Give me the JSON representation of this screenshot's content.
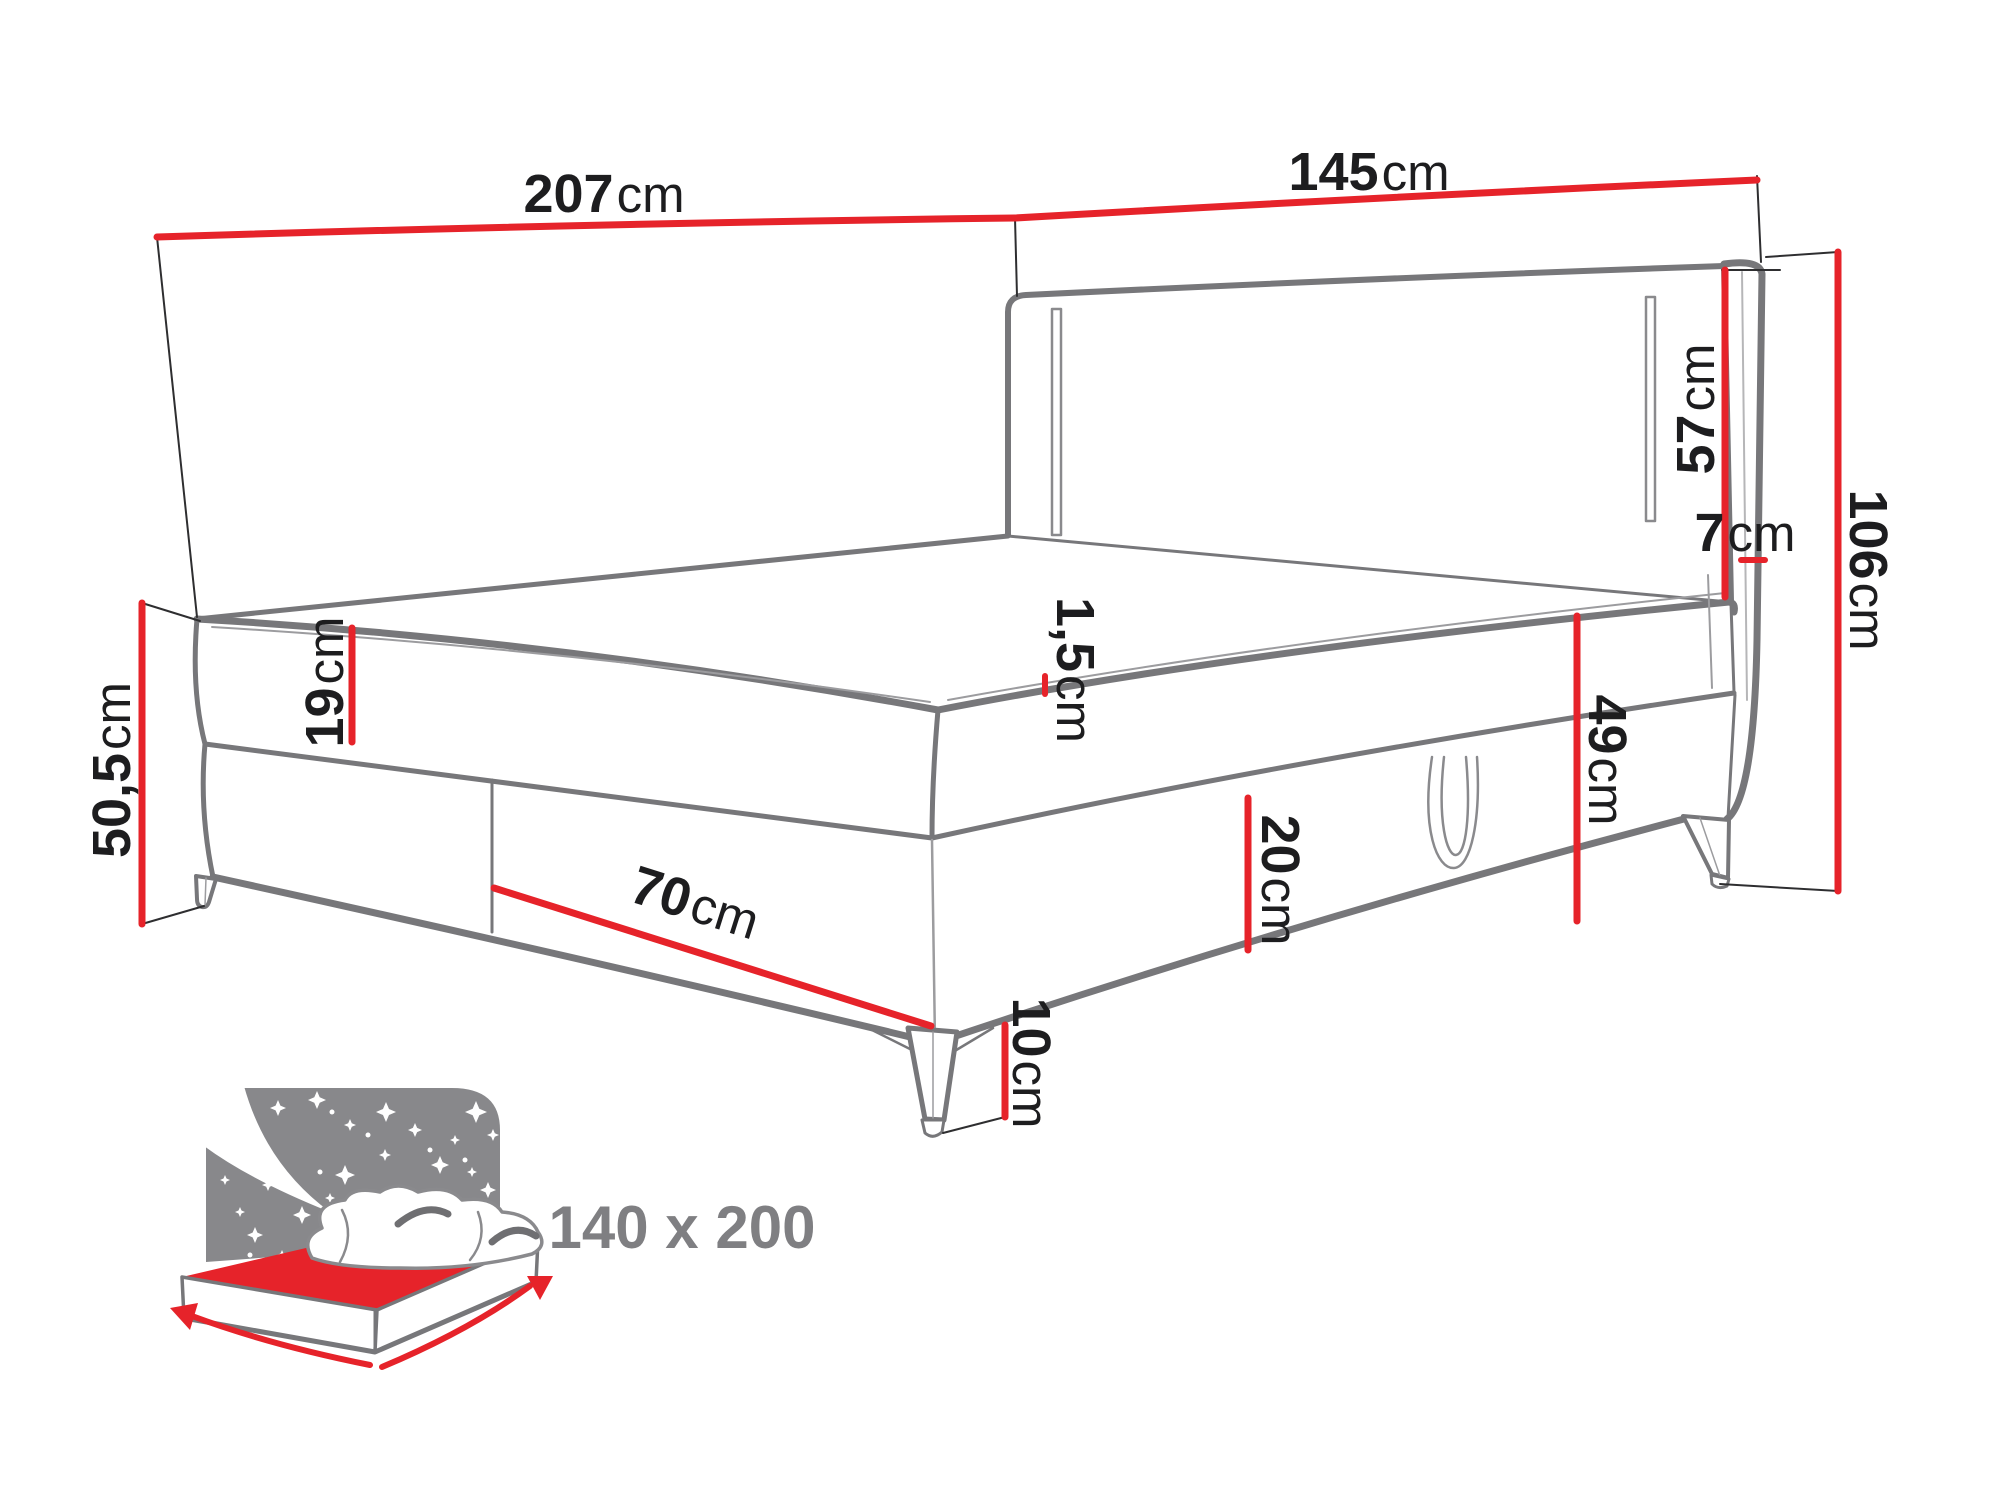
{
  "diagram": {
    "type": "furniture-dimension-diagram",
    "product": "boxspring bed with LED headboard",
    "unit": "cm",
    "dims": {
      "length": {
        "value": "207",
        "unit": "cm"
      },
      "width": {
        "value": "145",
        "unit": "cm"
      },
      "headboard_height": {
        "value": "57",
        "unit": "cm"
      },
      "headboard_depth": {
        "value": "7",
        "unit": "cm"
      },
      "total_height": {
        "value": "106",
        "unit": "cm"
      },
      "topper": {
        "value": "1,5",
        "unit": "cm"
      },
      "mattress": {
        "value": "19",
        "unit": "cm"
      },
      "seat_height": {
        "value": "50,5",
        "unit": "cm"
      },
      "storage": {
        "value": "70",
        "unit": "cm"
      },
      "base": {
        "value": "20",
        "unit": "cm"
      },
      "side_height": {
        "value": "49",
        "unit": "cm"
      },
      "leg": {
        "value": "10",
        "unit": "cm"
      }
    },
    "badge": {
      "size": "140 x 200"
    },
    "icons": [
      "bed-size-icon",
      "starry-headboard-icon",
      "moon-icon",
      "measure-arrow-icon"
    ],
    "colors": {
      "dimension_red": "#e6232a",
      "outline_grey": "#77777a",
      "icon_grey": "#88888b",
      "label_black": "#1d1d1f",
      "badge_grey": "#7f7f82"
    }
  }
}
